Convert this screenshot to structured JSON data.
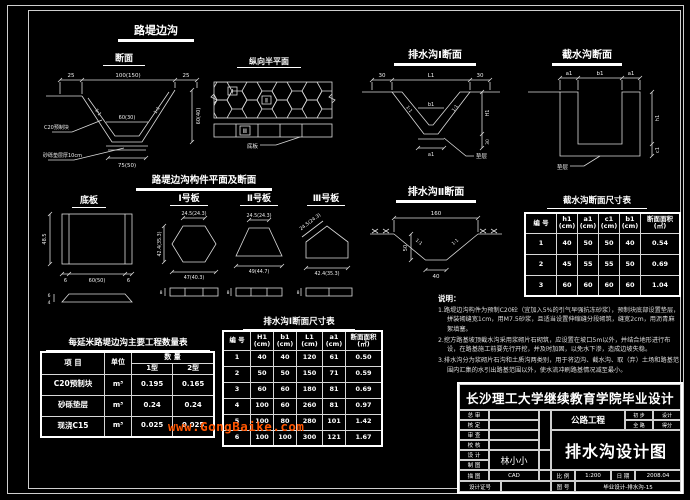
{
  "watermark": {
    "text": "www.GongBaike.com",
    "color": "#ff5500"
  },
  "colors": {
    "background": "#000000",
    "line": "#dcdcdc",
    "text": "#ffffff"
  },
  "s_luti": {
    "title": "路堤边沟",
    "sec": {
      "title": "断面",
      "d_top_l": "25",
      "d_top_m": "100(150)",
      "d_top_r": "25",
      "d_inner": "60(30)",
      "d_bottom": "75(50)",
      "d_height": "60(40)",
      "slope_l": "1:1",
      "slope_r": "1:1",
      "lbl_block": "C20预制块",
      "lbl_bed": "砂砾垫层厚10cm"
    },
    "plan": {
      "title": "纵向半平面",
      "m1": "Ⅰ",
      "m2": "Ⅱ",
      "m3": "Ⅲ",
      "leader": "底板"
    }
  },
  "s_ps1": {
    "title": "排水沟Ⅰ断面",
    "d_top_l": "30",
    "d_top_m": "L1",
    "d_top_r": "30",
    "d_inner": "b1",
    "d_bottom": "a1",
    "d_h": "H1",
    "d_h2": "30",
    "slope_l": "1:1",
    "slope_r": "1:1",
    "leader": "垫层"
  },
  "s_js": {
    "title": "截水沟断面",
    "d_a1": "a1",
    "d_b1": "b1",
    "d_a2": "a1",
    "d_h1": "h1",
    "d_c1": "c1",
    "leader": "垫层"
  },
  "s_comp": {
    "title": "路堤边沟构件平面及断面",
    "diban": {
      "title": "底板",
      "d_h": "48.5",
      "d_l": "6",
      "d_m": "60(50)",
      "d_r": "6",
      "d_s1": "6",
      "d_s2": "4"
    },
    "b1": {
      "title": "Ⅰ号板",
      "d_top": "24.5(24.3)",
      "d_left": "42.4(35.3)",
      "d_bot": "47(40.3)",
      "d_s": "8"
    },
    "b2": {
      "title": "Ⅱ号板",
      "d_top": "24.5(24.3)",
      "d_bot": "49(44.7)",
      "d_s": "8"
    },
    "b3": {
      "title": "Ⅲ号板",
      "d_top": "24.5(24.3)",
      "d_bot": "42.4(35.3)",
      "d_s": "8"
    }
  },
  "s_ps2": {
    "title": "排水沟Ⅱ断面",
    "d_top": "160",
    "d_bot": "40",
    "d_h": "50",
    "slope_l": "1:1",
    "slope_r": "1:1"
  },
  "t_js": {
    "title": "截水沟断面尺寸表",
    "h": [
      "编 号",
      "h1\n(cm)",
      "a1\n(cm)",
      "c1\n(cm)",
      "b1\n(cm)",
      "断面面积\n(㎡)"
    ],
    "rows": [
      [
        "1",
        "40",
        "50",
        "50",
        "40",
        "0.54"
      ],
      [
        "2",
        "45",
        "55",
        "55",
        "50",
        "0.69"
      ],
      [
        "3",
        "60",
        "60",
        "60",
        "60",
        "1.04"
      ]
    ]
  },
  "t_ps1": {
    "title": "排水沟Ⅰ断面尺寸表",
    "h": [
      "编 号",
      "H1\n(cm)",
      "b1\n(cm)",
      "L1\n(cm)",
      "a1\n(cm)",
      "断面面积\n(㎡)"
    ],
    "rows": [
      [
        "1",
        "40",
        "40",
        "120",
        "61",
        "0.50"
      ],
      [
        "2",
        "50",
        "50",
        "150",
        "71",
        "0.59"
      ],
      [
        "3",
        "60",
        "60",
        "180",
        "81",
        "0.69"
      ],
      [
        "4",
        "100",
        "60",
        "260",
        "81",
        "0.97"
      ],
      [
        "5",
        "100",
        "80",
        "280",
        "101",
        "1.42"
      ],
      [
        "6",
        "100",
        "100",
        "300",
        "121",
        "1.67"
      ]
    ]
  },
  "t_qty": {
    "title": "每延米路堤边沟主要工程数量表",
    "h_item": "项  目",
    "h_unit": "单位",
    "h_qty": "数  量",
    "h_t1": "1型",
    "h_t2": "2型",
    "rows": [
      [
        "C20预制块",
        "m³",
        "0.195",
        "0.165"
      ],
      [
        "砂砾垫层",
        "m³",
        "0.24",
        "0.24"
      ],
      [
        "现浇C15",
        "m³",
        "0.025",
        "0.025"
      ]
    ]
  },
  "notes": {
    "title": "说明：",
    "items": [
      "1.路堤边沟构件为预制C20砼（宜加入5%的引气早强抗冻砂浆），预制块底部设置垫层，拼装砌缝宽1cm，用M7.5砂浆，且适当设置伸缩缝分段砌筑，缝宽2cm，用沥青麻絮填塞。",
      "2.挖方路基坡顶截水沟采用浆砌片石砌筑，应设置在坡口5m以外，并结合地形进行布设，在路基施工前要先行开挖，并及时加固，以免水下渗，造成边坡失稳。",
      "3.排水沟分为浆砌片石沟和土质沟两类别，用于将边沟、截水沟、取（弃）土场和路基范围内汇集的水引出路基范围以外，使水流冲刷路基情况减至最小。"
    ]
  },
  "tb": {
    "university": "长沙理工大学继续教育学院毕业设计",
    "project": "公路工程",
    "drawing_title": "排水沟设计图",
    "r1l": "初 步",
    "r1v": "设计",
    "r2l": "全 路",
    "r2v": "得分",
    "labels": [
      "总 审",
      "核 定",
      "审 查",
      "校 核",
      "设 计",
      "制 图",
      "描 图"
    ],
    "cert_label": "设计证号",
    "designer": "林小小",
    "cad": "CAD",
    "scale_label": "比 例",
    "scale": "1:200",
    "date_label": "日 期",
    "date": "2008.04",
    "no_label": "图 号",
    "no": "毕业设计-排水沟-15"
  }
}
